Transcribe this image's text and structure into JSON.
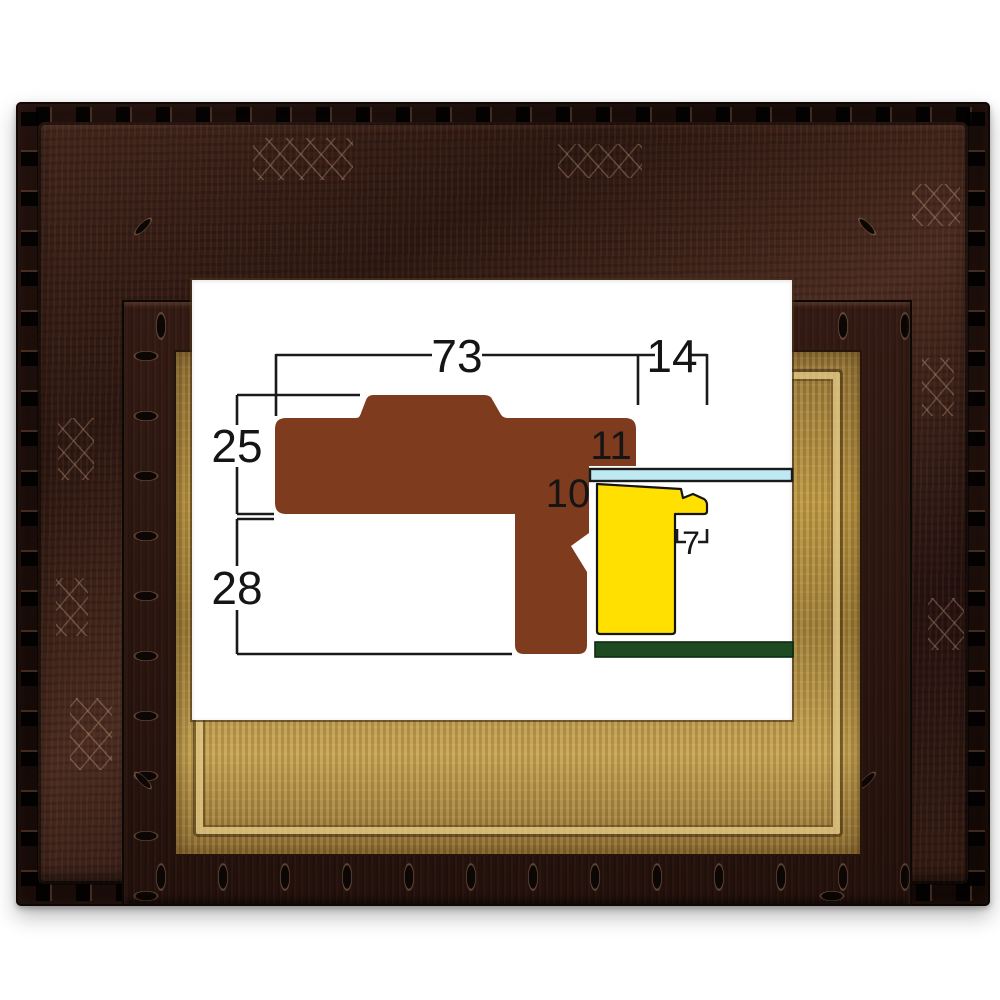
{
  "diagram": {
    "dimensions": {
      "overall_width": "73",
      "lip_width": "14",
      "upper_height": "25",
      "lower_depth": "28",
      "rabbet_height": "11",
      "liner_height": "10",
      "liner_step_width": "7"
    },
    "colors": {
      "moulding": "#7E3B1D",
      "liner": "#FFE000",
      "glass": "#BEE9F2",
      "backboard": "#1D4A20",
      "line": "#1A1A1A"
    }
  },
  "frame_photo": {
    "wood_dark": "#1A0D0A",
    "wood_mid": "#3A221B",
    "gold_liner": "#B8943F",
    "aperture_bg": "#FFFFFF"
  }
}
